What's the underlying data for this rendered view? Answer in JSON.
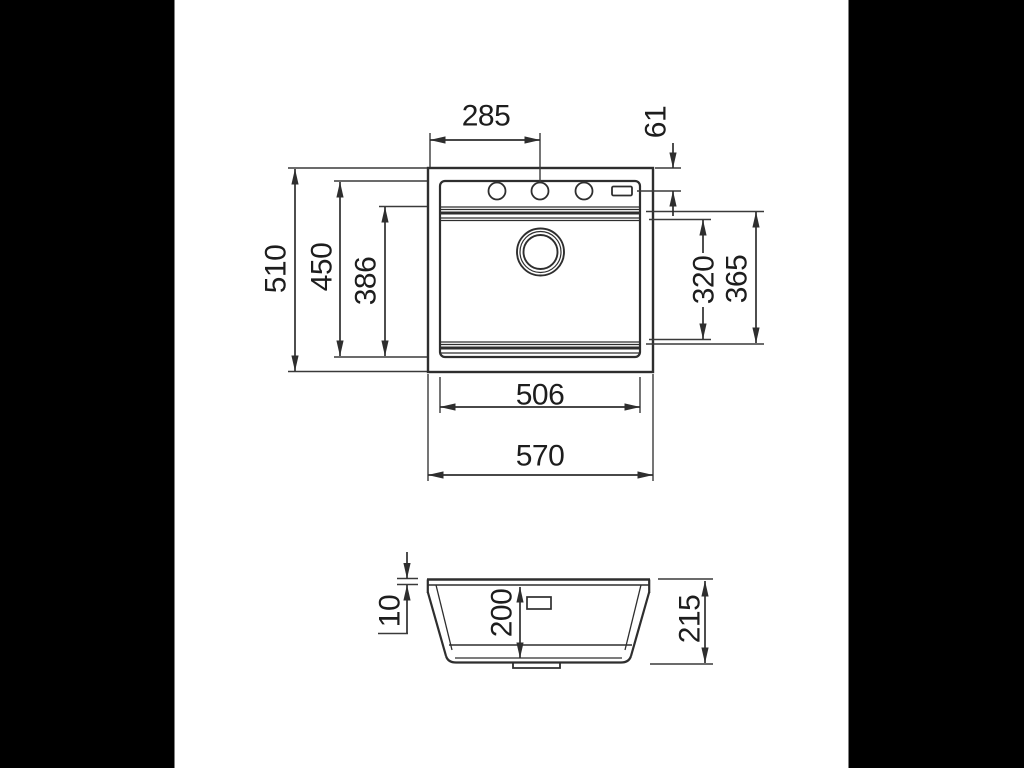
{
  "colors": {
    "letterbox_background": "#000000",
    "paper": "#ffffff",
    "line": "#2e2e2e",
    "text": "#1d1d1d"
  },
  "views": {
    "top": {
      "label": "sink plan view",
      "dims": {
        "hole_center_offset": "285",
        "hole_edge_offset": "61",
        "overall_depth": "510",
        "rim_inner_depth": "450",
        "bowl_front_to_back": "386",
        "bowl_opening_depth": "320",
        "bowl_base_depth": "365",
        "rim_inner_width": "506",
        "overall_width": "570"
      }
    },
    "section": {
      "label": "sink front section",
      "dims": {
        "rim_height": "10",
        "bowl_depth": "200",
        "overall_height": "215"
      }
    }
  }
}
